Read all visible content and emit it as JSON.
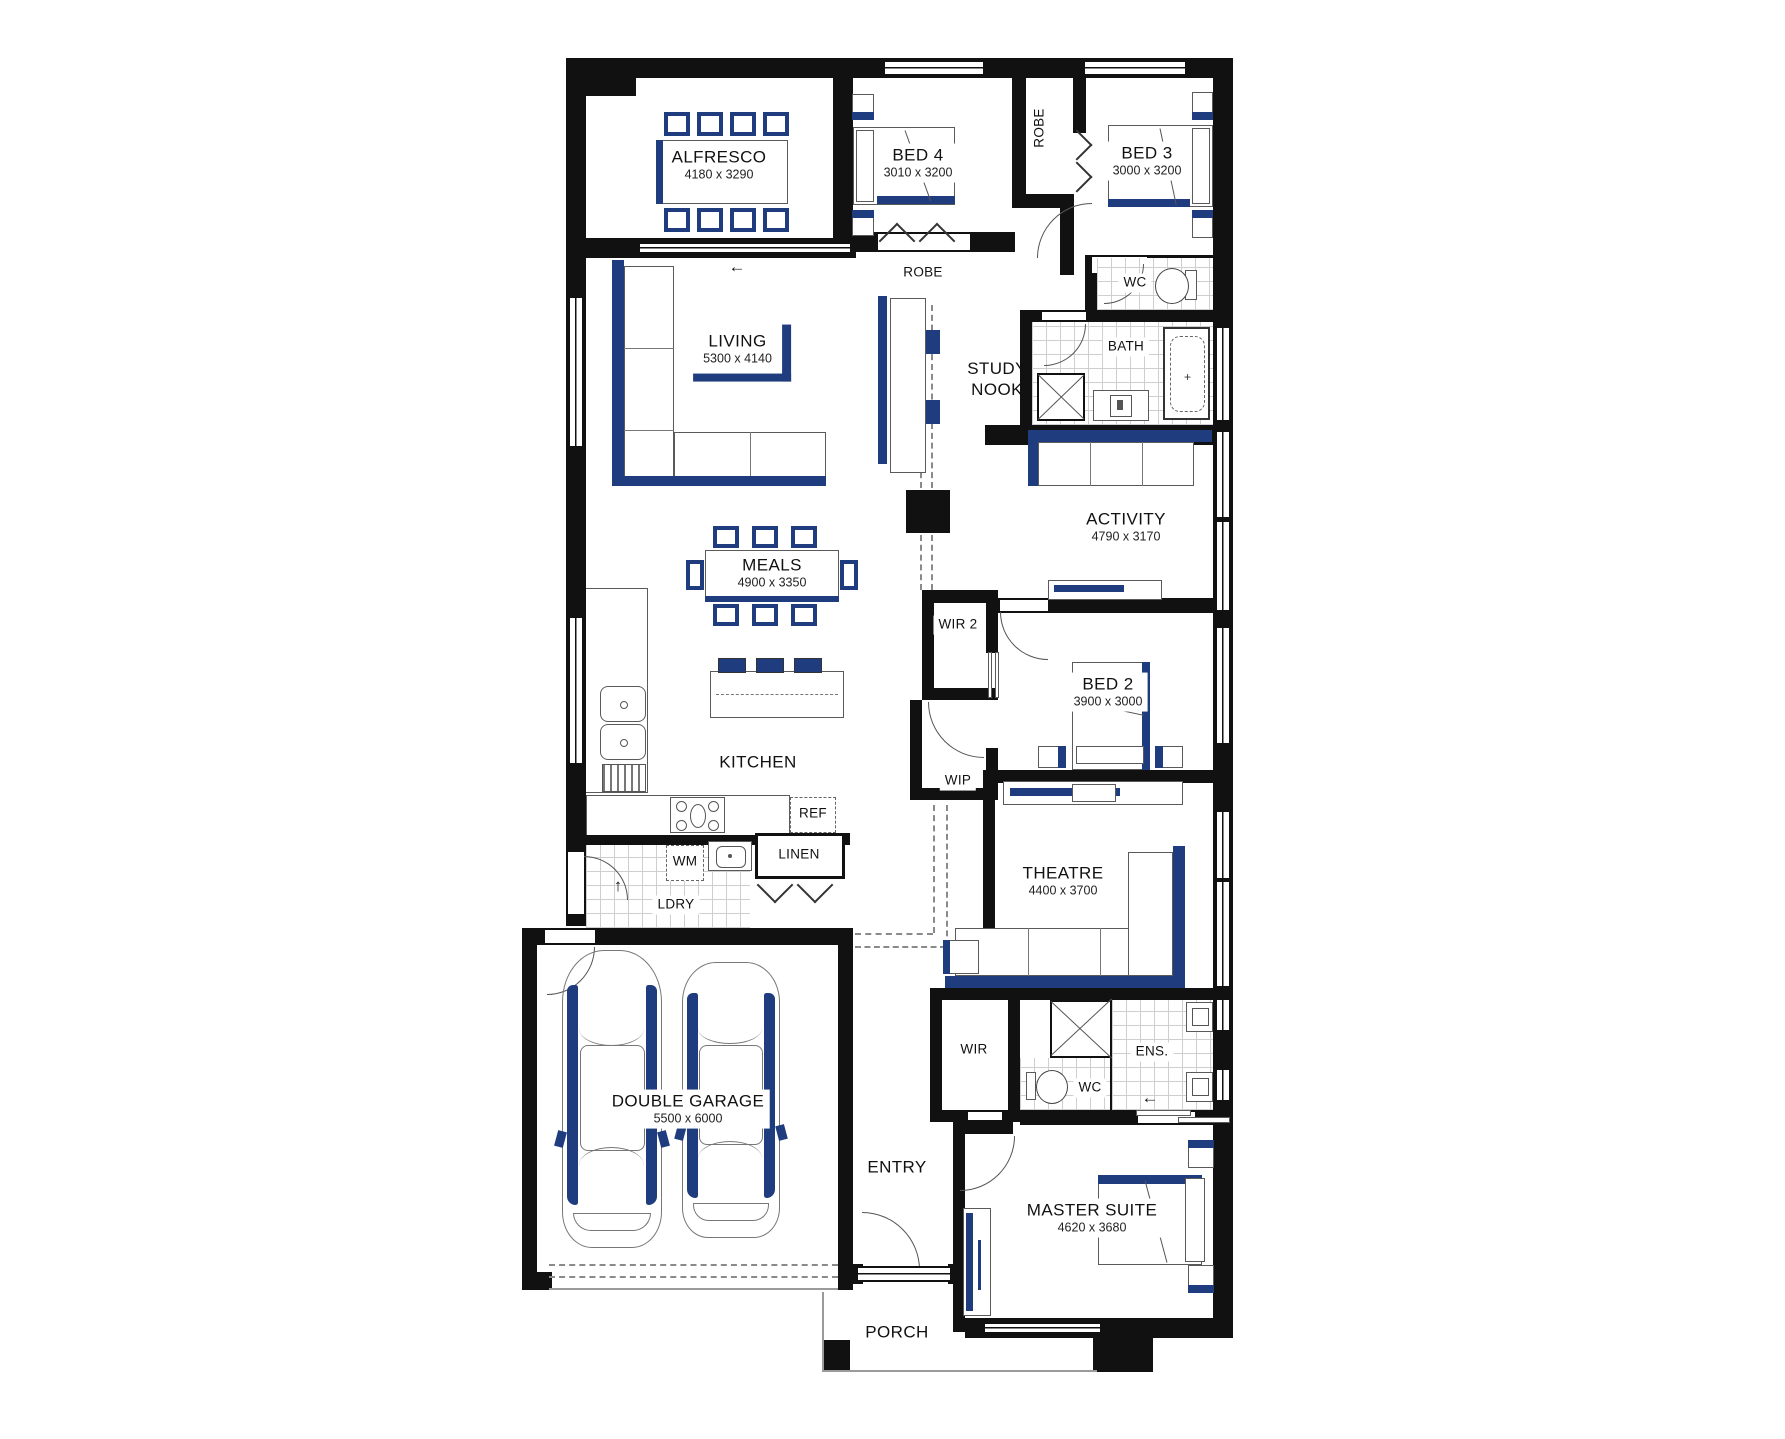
{
  "title": "Single storey home floor plan",
  "colors": {
    "accent": "#1f3c7f",
    "wall": "#111111"
  },
  "rooms": {
    "alfresco": {
      "label": "ALFRESCO",
      "dims": "4180 x 3290"
    },
    "bed4": {
      "label": "BED 4",
      "dims": "3010 x 3200"
    },
    "bed3": {
      "label": "BED 3",
      "dims": "3000 x 3200"
    },
    "robe_beds": {
      "label": "ROBE"
    },
    "robe_hall": {
      "label": "ROBE"
    },
    "living": {
      "label": "LIVING",
      "dims": "5300 x 4140"
    },
    "study": {
      "line1": "STUDY",
      "line2": "NOOK"
    },
    "wc_main": {
      "label": "WC"
    },
    "bath": {
      "label": "BATH"
    },
    "activity": {
      "label": "ACTIVITY",
      "dims": "4790 x 3170"
    },
    "meals": {
      "label": "MEALS",
      "dims": "4900 x 3350"
    },
    "kitchen": {
      "label": "KITCHEN"
    },
    "wir2": {
      "label": "WIR 2"
    },
    "bed2": {
      "label": "BED 2",
      "dims": "3900 x 3000"
    },
    "wip": {
      "label": "WIP"
    },
    "ref": {
      "label": "REF"
    },
    "linen": {
      "label": "LINEN"
    },
    "wm": {
      "label": "WM"
    },
    "ldry": {
      "label": "LDRY"
    },
    "theatre": {
      "label": "THEATRE",
      "dims": "4400 x 3700"
    },
    "wir": {
      "label": "WIR"
    },
    "ens": {
      "label": "ENS."
    },
    "wc_ens": {
      "label": "WC"
    },
    "garage": {
      "label": "DOUBLE GARAGE",
      "dims": "5500 x 6000"
    },
    "entry": {
      "label": "ENTRY"
    },
    "master": {
      "label": "MASTER SUITE",
      "dims": "4620 x 3680"
    },
    "porch": {
      "label": "PORCH"
    }
  },
  "arrows": {
    "slider": "←",
    "ldry": "↑",
    "ens": "←"
  }
}
